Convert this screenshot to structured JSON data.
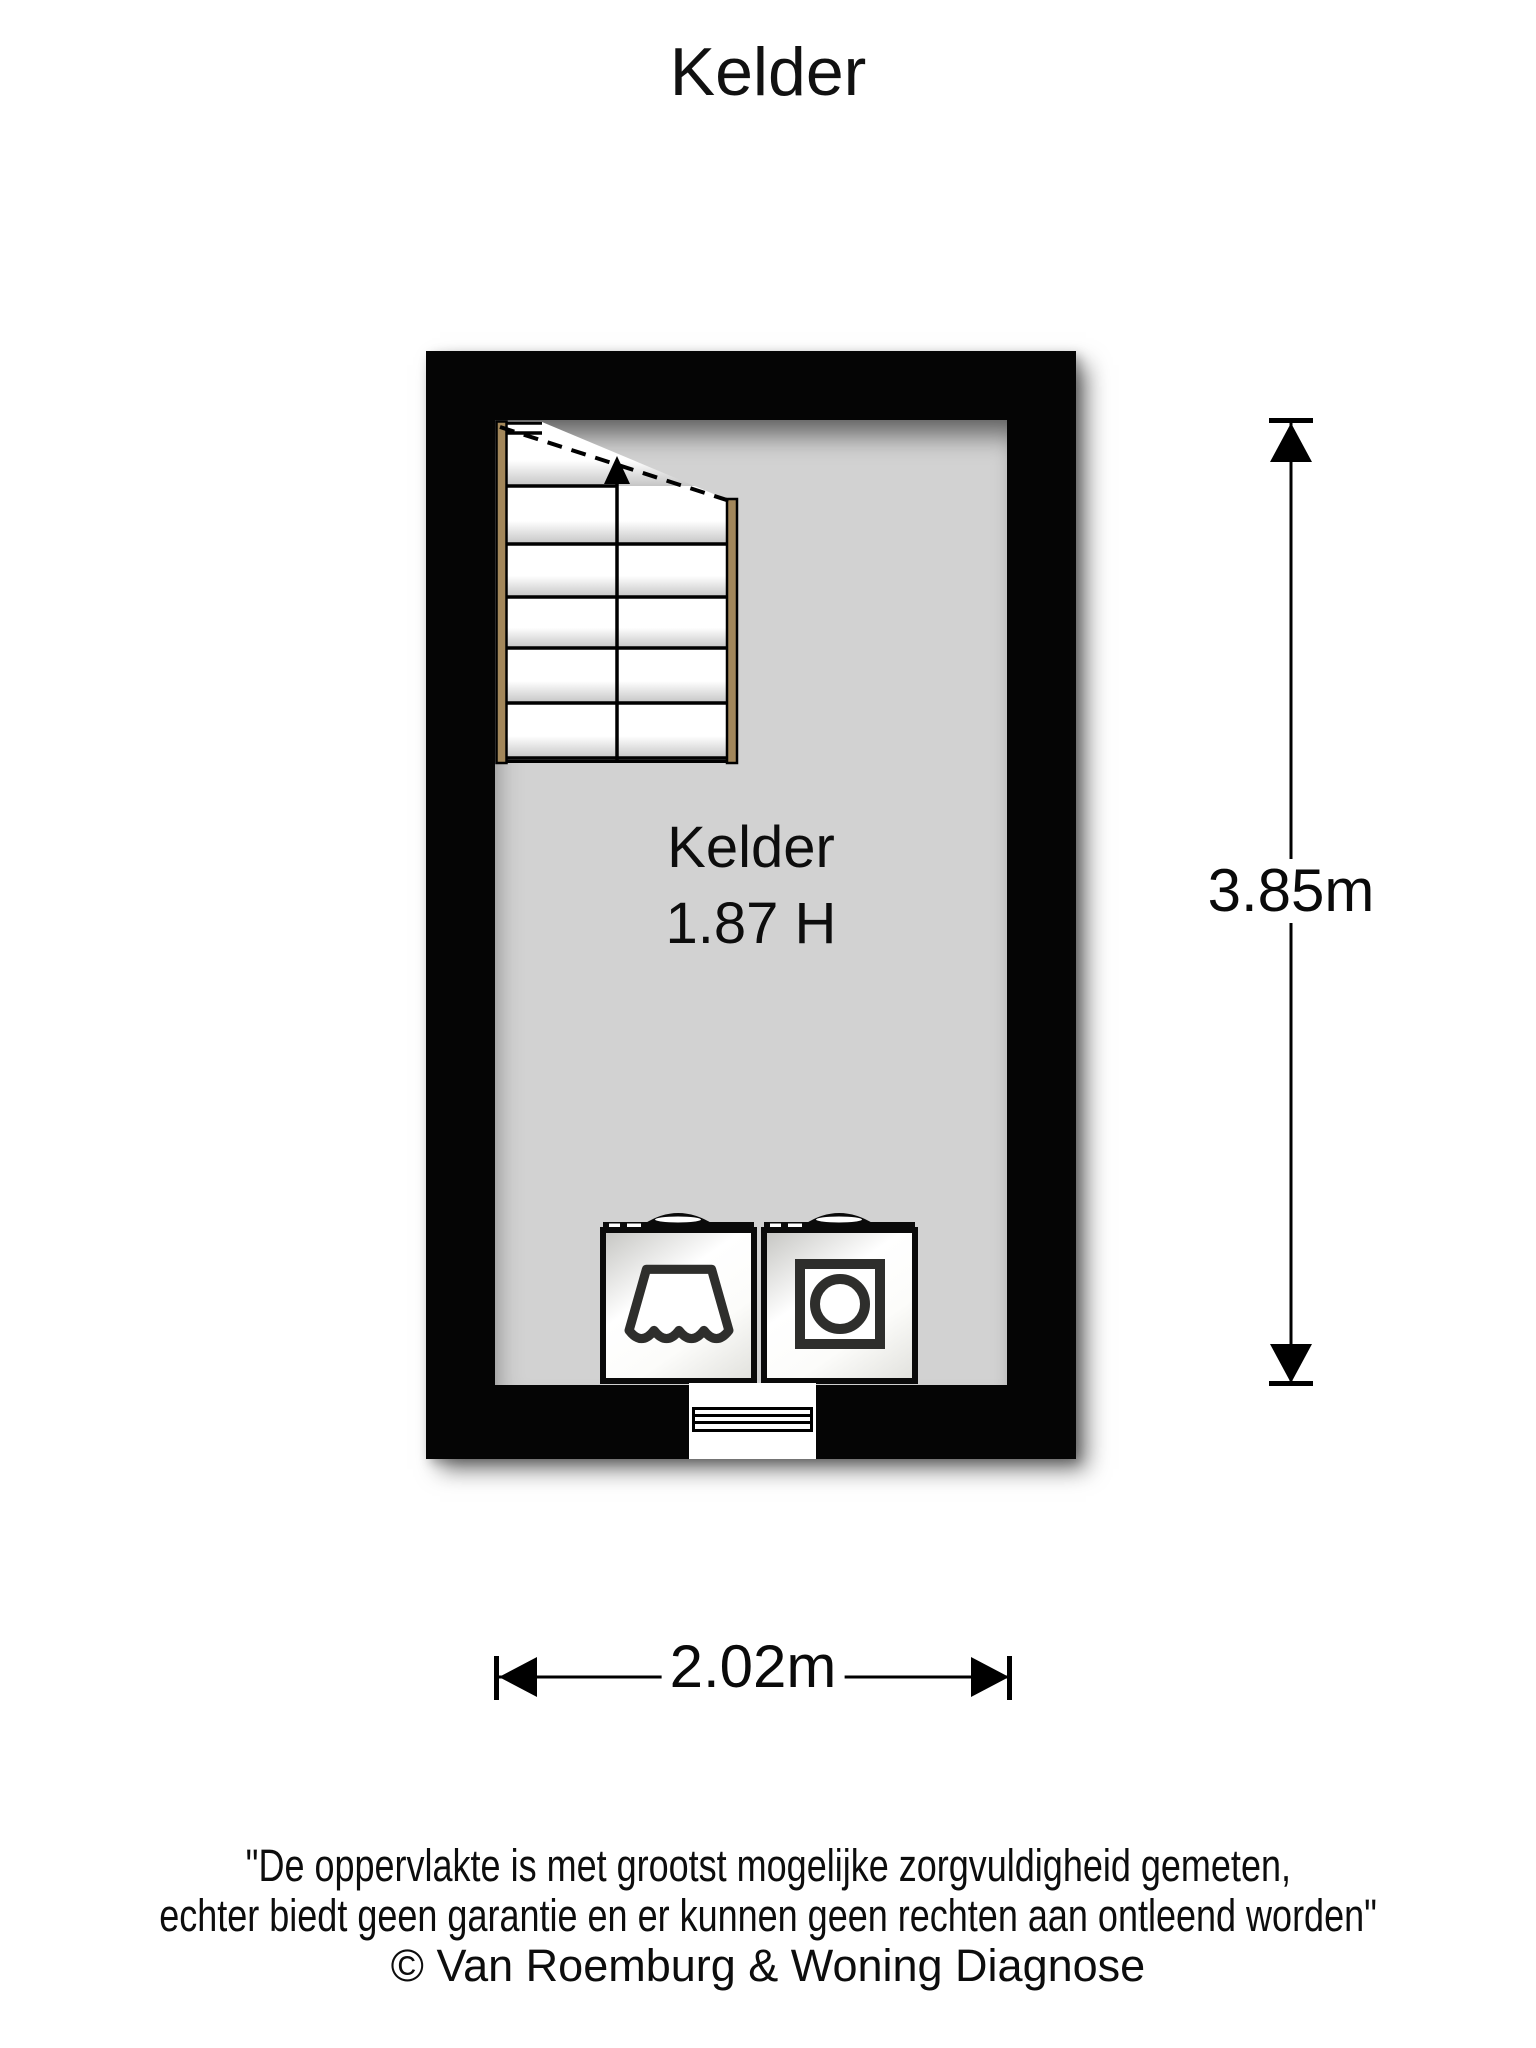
{
  "page": {
    "title": "Kelder"
  },
  "plan": {
    "room": {
      "name": "Kelder",
      "height_label": "1.87 H"
    },
    "dimensions": {
      "width": "2.02m",
      "height": "3.85m"
    },
    "features": {
      "staircase": "stairs-up-icon",
      "appliance_left": "sink-icon",
      "appliance_right": "washing-machine-icon",
      "door": "threshold-steps"
    },
    "colors": {
      "wall": "#050505",
      "floor": "#d2d2d2",
      "stair_stringer": "#a3875a",
      "icon_stroke": "#2e2e2c"
    }
  },
  "footer": {
    "line1": "\"De oppervlakte is met grootst mogelijke zorgvuldigheid gemeten,",
    "line2": "echter biedt geen garantie en er kunnen geen rechten aan ontleend worden\"",
    "line3": "© Van Roemburg & Woning Diagnose"
  }
}
